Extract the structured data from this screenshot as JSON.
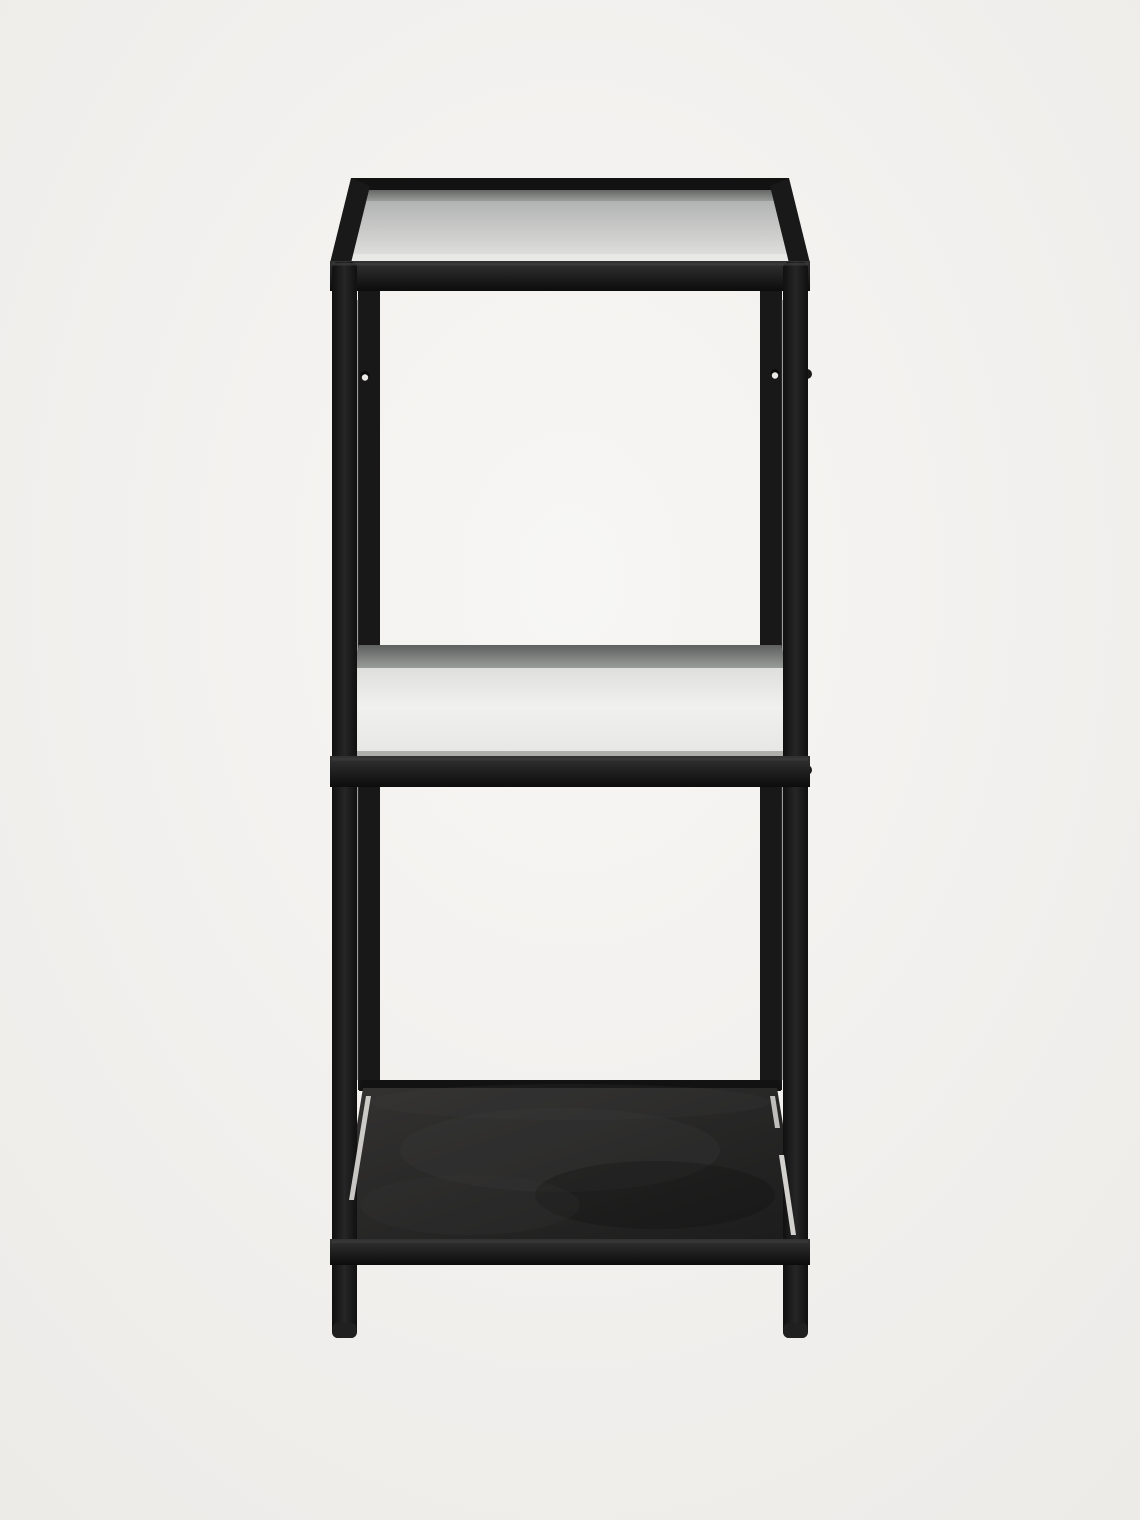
{
  "image": {
    "kind": "product-photo",
    "subject": "three-tier shelf unit, black metal frame, two clear glass shelves, solid black metal bottom shelf",
    "view": "front elevation, slightly above eye line",
    "background": "plain warm light-grey studio backdrop",
    "width": 1140,
    "height": 1520
  },
  "colors": {
    "background_center": "#f7f6f4",
    "background_edge": "#edebe8",
    "frame": "#191919",
    "back_rail": "#121212",
    "back_leg": "#181818",
    "seam_highlight": "#555555",
    "rail_top": "#333333",
    "rail_bottom": "#0c0c0c",
    "rail_sheen": "#3e3e3e",
    "leg_edge": "#101010",
    "leg_center": "#262626",
    "glass_back_tint": "#a7a9a8",
    "glass_front_tint": "#e3e3e1",
    "glass_edge_bright": "#efefed",
    "smoke_dark": "#585a59",
    "smoke_light": "#979997",
    "mid_glass_top": "#d4d4d2",
    "mid_glass_bright": "#f0f0ee",
    "mid_glass_low": "#e6e6e4",
    "edge_line": "#9b9b99",
    "shelf_top": "#333231",
    "shelf_bottom": "#1c1c1c",
    "mottle_light": "#404040",
    "mottle_dark": "#101010",
    "gap_light": "#e7e5e2",
    "screw_face": "#eae8e5",
    "screw_shadow": "#0a0a0a",
    "foot": "#202020"
  },
  "scene": {
    "shapes": [
      {
        "name": "studio-background",
        "kind": "rect",
        "x": 0,
        "y": 0,
        "w": 1140,
        "h": 1520,
        "fill": "g-bg"
      },
      {
        "name": "back-leg-left",
        "kind": "rect",
        "x": 358,
        "y": 186,
        "w": 22,
        "h": 904,
        "fill": "back_leg"
      },
      {
        "name": "back-leg-right",
        "kind": "rect",
        "x": 760,
        "y": 186,
        "w": 22,
        "h": 904,
        "fill": "back_leg"
      },
      {
        "name": "leg-seam-highlight-left",
        "kind": "rect",
        "x": 356.5,
        "y": 300,
        "w": 2,
        "h": 780,
        "fill": "seam_highlight",
        "opacity": 0.55
      },
      {
        "name": "leg-seam-highlight-right",
        "kind": "rect",
        "x": 781.5,
        "y": 300,
        "w": 2,
        "h": 780,
        "fill": "seam_highlight",
        "opacity": 0.55
      },
      {
        "name": "top-glass-shelf",
        "kind": "polygon",
        "points": "362,189 778,189 801,261 339,261",
        "fill": "g-topglass"
      },
      {
        "name": "top-glass-smoke-band",
        "kind": "polygon",
        "points": "362,189 778,189 783,201 357,201",
        "fill": "g-smoke",
        "opacity": 0.9
      },
      {
        "name": "top-glass-front-edge",
        "kind": "polygon",
        "points": "340,254 800,254 801,261 339,261",
        "fill": "glass_edge_bright",
        "opacity": 0.55
      },
      {
        "name": "top-back-rail",
        "kind": "polygon",
        "points": "351,178 789,178 782,190 358,190",
        "fill": "back_rail"
      },
      {
        "name": "top-corner-rail-left",
        "kind": "polygon",
        "points": "351,178 370,186 351,263 330,263",
        "fill": "frame"
      },
      {
        "name": "top-corner-rail-right",
        "kind": "polygon",
        "points": "789,178 770,186 789,263 810,263",
        "fill": "frame"
      },
      {
        "name": "top-front-rail",
        "kind": "rect",
        "x": 330,
        "y": 261,
        "w": 480,
        "h": 30,
        "fill": "g-rail"
      },
      {
        "name": "middle-glass-shelf",
        "kind": "polygon",
        "points": "359,645 781,645 802,757 338,757",
        "fill": "g-midglass"
      },
      {
        "name": "middle-glass-smoke-band",
        "kind": "polygon",
        "points": "359,645 781,645 787,668 353,668",
        "fill": "g-smoke",
        "opacity": 0.95
      },
      {
        "name": "middle-glass-front-edge",
        "kind": "polygon",
        "points": "338,751 802,751 802,757 338,757",
        "fill": "edge_line",
        "opacity": 0.75
      },
      {
        "name": "bottom-shelf-back-rail",
        "kind": "polygon",
        "points": "361,1080 779,1080 781,1091 359,1091",
        "fill": "back_rail"
      },
      {
        "name": "bottom-metal-shelf",
        "kind": "polygon",
        "points": "363,1088 777,1088 802,1240 338,1240",
        "fill": "g-shelf"
      },
      {
        "name": "bottom-shelf-sheen",
        "kind": "ellipse",
        "cx": 570,
        "cy": 1102,
        "rx": 200,
        "ry": 18,
        "fill": "mottle_light",
        "opacity": 0.18
      },
      {
        "name": "bottom-shelf-mottle-1",
        "kind": "ellipse",
        "cx": 560,
        "cy": 1150,
        "rx": 160,
        "ry": 42,
        "fill": "mottle_light",
        "opacity": 0.22
      },
      {
        "name": "bottom-shelf-mottle-2",
        "kind": "ellipse",
        "cx": 655,
        "cy": 1195,
        "rx": 120,
        "ry": 34,
        "fill": "mottle_dark",
        "opacity": 0.28
      },
      {
        "name": "bottom-shelf-mottle-3",
        "kind": "ellipse",
        "cx": 470,
        "cy": 1205,
        "rx": 110,
        "ry": 30,
        "fill": "mottle_light",
        "opacity": 0.16
      },
      {
        "name": "side-screw-bump-upper-right",
        "kind": "circle",
        "cx": 807,
        "cy": 374,
        "r": 5,
        "fill": "frame"
      },
      {
        "name": "side-screw-bump-middle-right",
        "kind": "circle",
        "cx": 807,
        "cy": 770,
        "r": 5,
        "fill": "frame"
      },
      {
        "name": "front-leg-left",
        "kind": "rect",
        "x": 332,
        "y": 262,
        "w": 25,
        "h": 1076,
        "rx": 6,
        "fill": "g-leg"
      },
      {
        "name": "front-leg-right",
        "kind": "rect",
        "x": 783,
        "y": 262,
        "w": 25,
        "h": 1076,
        "rx": 6,
        "fill": "g-leg"
      },
      {
        "name": "screw-hole-left-shadow",
        "kind": "circle",
        "cx": 365,
        "cy": 375.5,
        "r": 4.5,
        "fill": "screw_shadow"
      },
      {
        "name": "screw-hole-left",
        "kind": "circle",
        "cx": 365,
        "cy": 377.5,
        "r": 3.2,
        "fill": "screw_face"
      },
      {
        "name": "screw-hole-right-shadow",
        "kind": "circle",
        "cx": 775,
        "cy": 373.5,
        "r": 4.5,
        "fill": "screw_shadow"
      },
      {
        "name": "screw-hole-right",
        "kind": "circle",
        "cx": 775,
        "cy": 375.5,
        "r": 3.2,
        "fill": "screw_face"
      },
      {
        "name": "shelf-gap-highlight-left",
        "kind": "polygon",
        "points": "366,1096 371,1096 354,1200 349,1200",
        "fill": "gap_light",
        "opacity": 0.85
      },
      {
        "name": "shelf-gap-highlight-right-upper",
        "kind": "polygon",
        "points": "770,1096 775,1096 780,1128 775,1128",
        "fill": "gap_light",
        "opacity": 0.8
      },
      {
        "name": "shelf-gap-highlight-right-lower",
        "kind": "polygon",
        "points": "779,1155 784,1155 796,1235 791,1235",
        "fill": "gap_light",
        "opacity": 0.9
      },
      {
        "name": "middle-front-rail",
        "kind": "rect",
        "x": 330,
        "y": 756,
        "w": 480,
        "h": 31,
        "fill": "g-rail"
      },
      {
        "name": "bottom-front-rail",
        "kind": "rect",
        "x": 330,
        "y": 1239,
        "w": 480,
        "h": 26,
        "fill": "g-rail"
      },
      {
        "name": "foot-cap-left",
        "kind": "rect",
        "x": 332.5,
        "y": 1323,
        "w": 24,
        "h": 15,
        "rx": 5,
        "fill": "foot"
      },
      {
        "name": "foot-cap-right",
        "kind": "rect",
        "x": 783.5,
        "y": 1323,
        "w": 24,
        "h": 15,
        "rx": 5,
        "fill": "foot"
      },
      {
        "name": "top-rail-sheen",
        "kind": "rect",
        "x": 332,
        "y": 263,
        "w": 476,
        "h": 2.5,
        "fill": "rail_sheen",
        "opacity": 0.7
      },
      {
        "name": "middle-rail-sheen",
        "kind": "rect",
        "x": 332,
        "y": 758,
        "w": 476,
        "h": 2.5,
        "fill": "rail_sheen",
        "opacity": 0.6
      },
      {
        "name": "bottom-rail-sheen",
        "kind": "rect",
        "x": 332,
        "y": 1240.5,
        "w": 476,
        "h": 2.5,
        "fill": "rail_sheen",
        "opacity": 0.5
      }
    ]
  }
}
